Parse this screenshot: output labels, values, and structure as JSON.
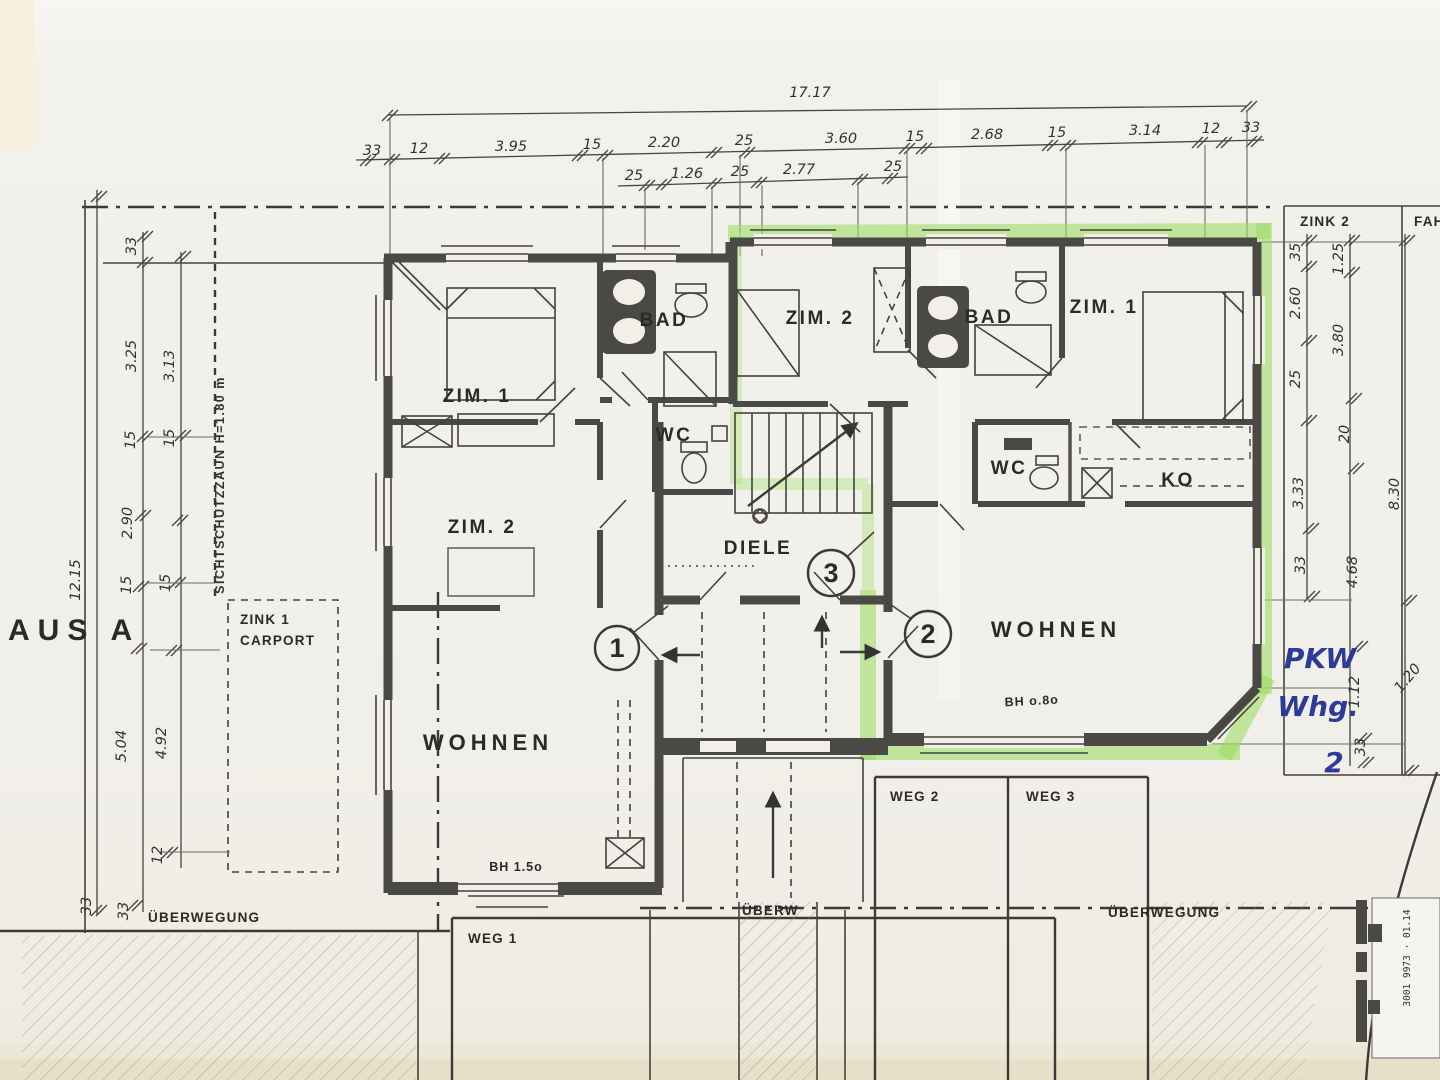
{
  "colors": {
    "paper": "#f1efe9",
    "ink": "#35332f",
    "wall_gray": "#4b4946",
    "highlighter_green": "#9edc66",
    "pen_blue": "#2b3a9b"
  },
  "labels": {
    "haus": "AUS A",
    "fence": "SICHTSCHUTZZAUN H=1.80 m",
    "zink1_line1": "ZINK 1",
    "zink1_line2": "CARPORT",
    "zink2": "ZINK 2",
    "fah": "FAH",
    "diele": "DIELE",
    "rooms_left": {
      "zim1": "ZIM. 1",
      "zim2": "ZIM. 2",
      "bad": "BAD",
      "wc": "WC",
      "wohnen": "WOHNEN",
      "bh": "BH 1.5o"
    },
    "rooms_right": {
      "zim1": "ZIM. 1",
      "zim2": "ZIM. 2",
      "bad": "BAD",
      "wc": "WC",
      "ko": "KO",
      "wohnen": "WOHNEN",
      "bh": "BH o.8o"
    },
    "unit_markers": {
      "one": "1",
      "two": "2",
      "three": "3"
    },
    "site": {
      "ueberwegung_left": "ÜBERWEGUNG",
      "weg1": "WEG 1",
      "ueberw": "ÜBERW",
      "weg2": "WEG 2",
      "weg3": "WEG 3",
      "ueberwegung_right": "ÜBERWEGUNG"
    },
    "handwritten": {
      "line1": "PKW",
      "line2": "Whg.",
      "line3": "2"
    },
    "stamp": "3001 9973 · 01.14"
  },
  "dims": {
    "total_width": "17.17",
    "top_main": [
      "33",
      "12",
      "3.95",
      "15",
      "2.20",
      "25",
      "3.60",
      "15",
      "2.68",
      "15",
      "3.14",
      "12",
      "33"
    ],
    "top_sub": [
      "25",
      "1.26",
      "25",
      "2.77",
      "25"
    ],
    "left_outer": "12.15",
    "left_inner": [
      "33",
      "3.25",
      "15",
      "2.90",
      "15",
      "5.04",
      "33"
    ],
    "left_inner2": [
      "3.13",
      "15",
      "15",
      "4.92",
      "12",
      "33"
    ],
    "right_inner": [
      "35",
      "2.60",
      "25",
      "3.33",
      "33"
    ],
    "right_inner2": [
      "1.25",
      "3.80",
      "20",
      "4.68",
      "1.12",
      "33"
    ],
    "right_outer": [
      "8.30",
      "1.20"
    ]
  }
}
